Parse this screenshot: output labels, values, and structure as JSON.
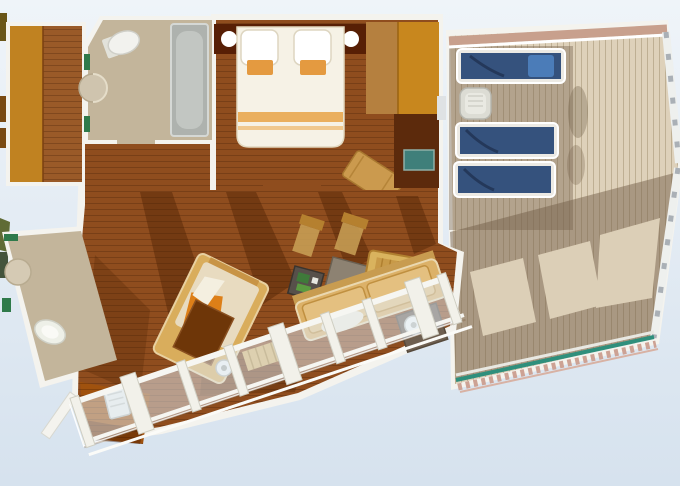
{
  "floor_plan": {
    "type": "cruise-ship-suite-floor-plan",
    "view": "top-down-3d-render",
    "rooms": [
      {
        "name": "walk-in-closet",
        "features": [
          "wardrobe",
          "wood-floor"
        ]
      },
      {
        "name": "master-bathroom",
        "features": [
          "bathtub",
          "toilet",
          "sink",
          "green-towel-accents"
        ],
        "shape": "chamfered-corner"
      },
      {
        "name": "master-bedroom",
        "features": [
          "double-bed",
          "two-pillows",
          "headboard",
          "two-round-lamps",
          "wardrobe",
          "dark-cabinet",
          "tv-screen",
          "angled-bench"
        ]
      },
      {
        "name": "hallway",
        "features": [
          "wood-floor"
        ]
      },
      {
        "name": "living-room",
        "features": [
          "chaise-lounge",
          "ottoman",
          "sofa",
          "armchair",
          "coffee-table",
          "side-table-green",
          "kettle-table",
          "bar-chair",
          "bar-chair",
          "slatted-step",
          "cast-shadows"
        ]
      },
      {
        "name": "guest-bathroom",
        "features": [
          "toilet",
          "sink",
          "green-towel-accents"
        ],
        "shape": "angled-trapezoid"
      },
      {
        "name": "cabin-balcony",
        "features": [
          "glass-railing",
          "railing-posts",
          "small-white-table",
          "dark-wood-floor"
        ]
      },
      {
        "name": "private-sun-deck",
        "features": [
          "sun-lounger",
          "sun-lounger",
          "sun-lounger",
          "side-table",
          "perimeter-railing",
          "teal-deck-trim",
          "railing-shadow-pattern"
        ]
      }
    ],
    "counts": {
      "sun_loungers": 3,
      "bathrooms": 2,
      "beds": 1,
      "balconies": 2
    }
  },
  "palette": {
    "background_top": "#eff4f9",
    "background_bottom": "#d6e2ee",
    "wall_white": "#f4f3ee",
    "wood_floor": "#8f4d1e",
    "wood_floor_light": "#b5803f",
    "closet_wardrobe": "#c08221",
    "closet_floor": "#9a5a28",
    "bathroom_floor": "#c3b59b",
    "tub_gray": "#aeb2ae",
    "fixture_white": "#f2f2ee",
    "green_accent": "#2f7a4a",
    "headboard_dark": "#571f05",
    "bed_linen": "#f6f2e6",
    "bed_orange": "#e49a40",
    "deck_planks": "#ded1ba",
    "deck_shadow": "#73604a",
    "lounger_navy": "#35527d",
    "lounger_towel": "#4b7cb8",
    "teal_trim": "#2f8f7c",
    "rail_pink": "#c8a08d",
    "sofa_tan": "#dcb168",
    "chaise_tan": "#d9ad5c",
    "orange_throw": "#dd7f18",
    "ottoman_dark": "#6e3608",
    "cabinet_dark": "#5c2a0c",
    "tv_teal": "#3f7f7a",
    "balcony_floor_dark": "#a0520e"
  }
}
